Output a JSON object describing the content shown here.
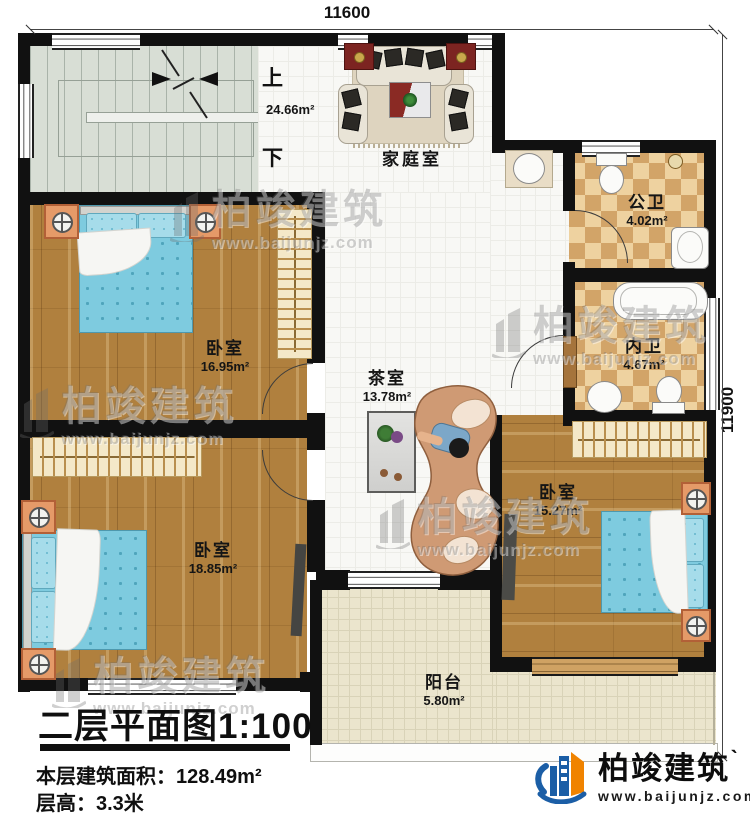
{
  "dimensions": {
    "top": "11600",
    "right": "11900"
  },
  "stairs": {
    "up": "上",
    "down": "下"
  },
  "rooms": {
    "family": {
      "name": "家庭室",
      "area": "24.66m²"
    },
    "bedroom_top_left": {
      "name": "卧室",
      "area": "16.95m²"
    },
    "bedroom_bottom_left": {
      "name": "卧室",
      "area": "18.85m²"
    },
    "bedroom_right": {
      "name": "卧室",
      "area": "15.27m²"
    },
    "tea_room": {
      "name": "茶室",
      "area": "13.78m²"
    },
    "public_bath": {
      "name": "公卫",
      "area": "4.02m²"
    },
    "private_bath": {
      "name": "内卫",
      "area": "4.67m²"
    },
    "balcony": {
      "name": "阳台",
      "area": "5.80m²"
    }
  },
  "title": {
    "text": "二层平面图",
    "scale": "1:100"
  },
  "info": {
    "floor_area_label": "本层建筑面积：",
    "floor_area_value": "128.49m²",
    "floor_height_label": "层高：",
    "floor_height_value": "3.3米"
  },
  "brand": {
    "name": "柏竣建筑",
    "tick": "ˋ",
    "url": "www.baijunjz.com"
  },
  "watermark": {
    "name": "柏竣建筑",
    "url": "www.baijunjz.com"
  },
  "colors": {
    "wall": "#111111",
    "wood_floor": "#b0803e",
    "bath_tile_light": "#eed2a0",
    "bath_tile_dark": "#d2a468",
    "balcony_floor": "#ebe5cd",
    "stair_floor": "#d8ded5",
    "bed_blue": "#7ecbdf",
    "brand_blue": "#1b5ea6",
    "brand_orange": "#f08300"
  }
}
